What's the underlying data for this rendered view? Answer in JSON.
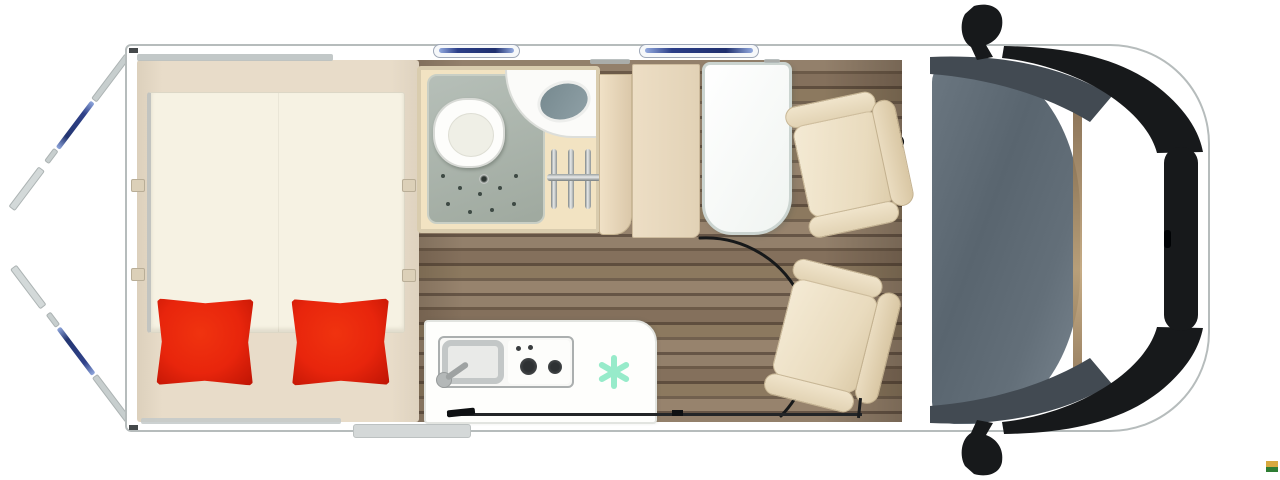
{
  "diagram": {
    "kind": "campervan-floorplan-top-view",
    "description": "Top-down floor plan of a panel-van motorhome with open rear doors",
    "areas": {
      "bed": {
        "label": "Rear transverse bed",
        "pillow_count": 2
      },
      "bathroom": {
        "label": "Bathroom",
        "fixtures": [
          "toilet",
          "shower tray",
          "corner washbasin",
          "shower rail"
        ]
      },
      "wardrobe": {
        "label": "Wardrobe cabinets"
      },
      "kitchen": {
        "label": "Kitchenette",
        "fixtures": [
          "sink with faucet",
          "two-burner hob",
          "fridge snowflake symbol"
        ]
      },
      "dinette": {
        "label": "Dinette",
        "fixtures": [
          "table",
          "swivel cab seat 1",
          "swivel cab seat 2",
          "seat swivel arc"
        ]
      },
      "cab": {
        "label": "Driver cab",
        "fixtures": [
          "windshield",
          "steering wheel",
          "side mirror top",
          "side mirror bottom",
          "front grille"
        ]
      },
      "openings": {
        "rear_doors": "two rear doors shown swung open with window glass",
        "sliding_door": "side sliding door rail on bottom wall",
        "wall_windows": [
          "awning window 1",
          "awning window 2"
        ],
        "entry_step": "exterior step at sliding door"
      }
    },
    "counts": {
      "seats": 2,
      "pillows": 2,
      "wall_windows": 2,
      "hob_burners": 2,
      "shower_rail_bars": 3
    }
  },
  "palette": {
    "body_white": "#FFFFFF",
    "outline_gray": "#B6BCBC",
    "wood_floor_brown": "#84705C",
    "bed_base_tan": "#E6DAC6",
    "mattress_ivory": "#F6F2E3",
    "pillow_red": "#E8250C",
    "bathroom_tan": "#F2E3C2",
    "shower_tray_gray": "#A9B3AB",
    "cabinet_beige": "#E9DABF",
    "seat_beige": "#EFE3CB",
    "counter_white": "#FEFEFC",
    "freezer_mint": "#97EBCA",
    "windshield_gray": "#616D77",
    "window_glass_blue": "#2B3E88",
    "trim_black": "#17191B",
    "logo_yellow": "#D7A93F",
    "logo_green": "#2E7D33"
  }
}
